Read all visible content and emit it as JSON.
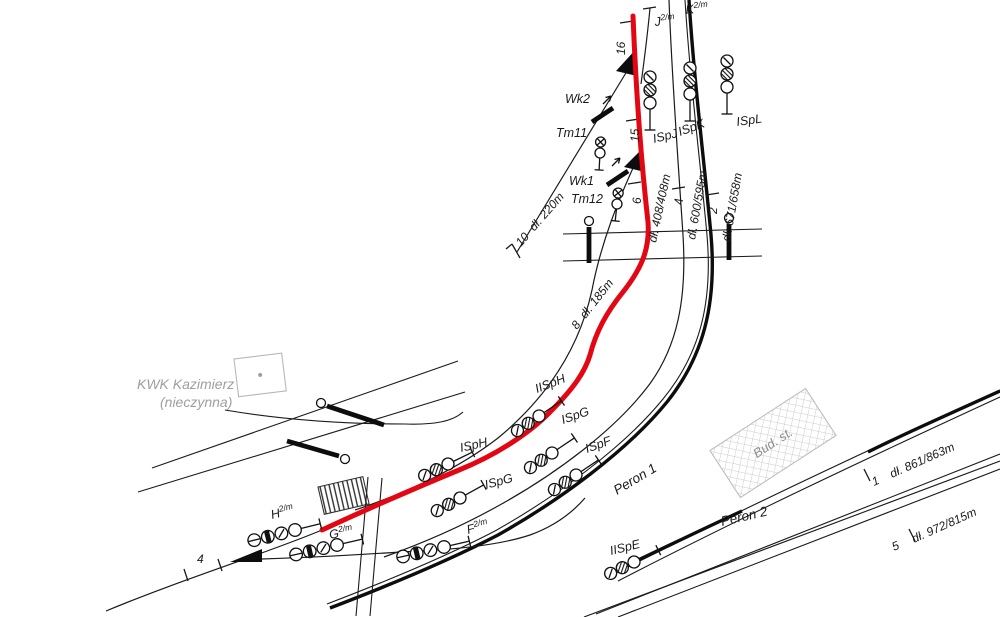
{
  "labels": {
    "site": {
      "name": "KWK Kazimierz",
      "status": "(nieczynna)"
    },
    "building": "Bud. st.",
    "platform1": "Peron 1",
    "platform2": "Peron 2"
  },
  "track_ends": {
    "j": {
      "base": "J",
      "sup": "2/m"
    },
    "k": {
      "base": "K",
      "sup": "2/m"
    },
    "h": {
      "base": "H",
      "sup": "2/m"
    },
    "g": {
      "base": "G",
      "sup": "2/m"
    },
    "f": {
      "base": "F",
      "sup": "2/m"
    }
  },
  "track_numbers": {
    "t16": "16",
    "t15": "15",
    "t10": "10",
    "t8": "8",
    "t6": "6",
    "t4": "4",
    "t2": "2",
    "t4b": "4",
    "t1": "1",
    "t5": "5"
  },
  "track_lengths": {
    "t10": "dł. 220m",
    "t8": "dł. 185m",
    "t6": "dł. 408/408m",
    "t4": "dł. 600/595m",
    "t2": "dł. 671/658m",
    "t1": "dł. 861/863m",
    "t5": "dł. 972/815m"
  },
  "signals": {
    "ispj": "ISpJ",
    "ispk": "ISpK",
    "ispl": "ISpL",
    "iisph": "IISpH",
    "ispg_upper": "ISpG",
    "isph": "ISpH",
    "ispf": "ISpF",
    "ispg_lower": "ISpG",
    "iispe": "IISpE"
  },
  "shunting_signals": {
    "tm11": "Tm11",
    "tm12": "Tm12"
  },
  "derailers": {
    "wk1": "Wk1",
    "wk2": "Wk2"
  },
  "colors": {
    "route": "#e30613",
    "track": "#1a1a1a",
    "muted": "#9f9f9f"
  }
}
